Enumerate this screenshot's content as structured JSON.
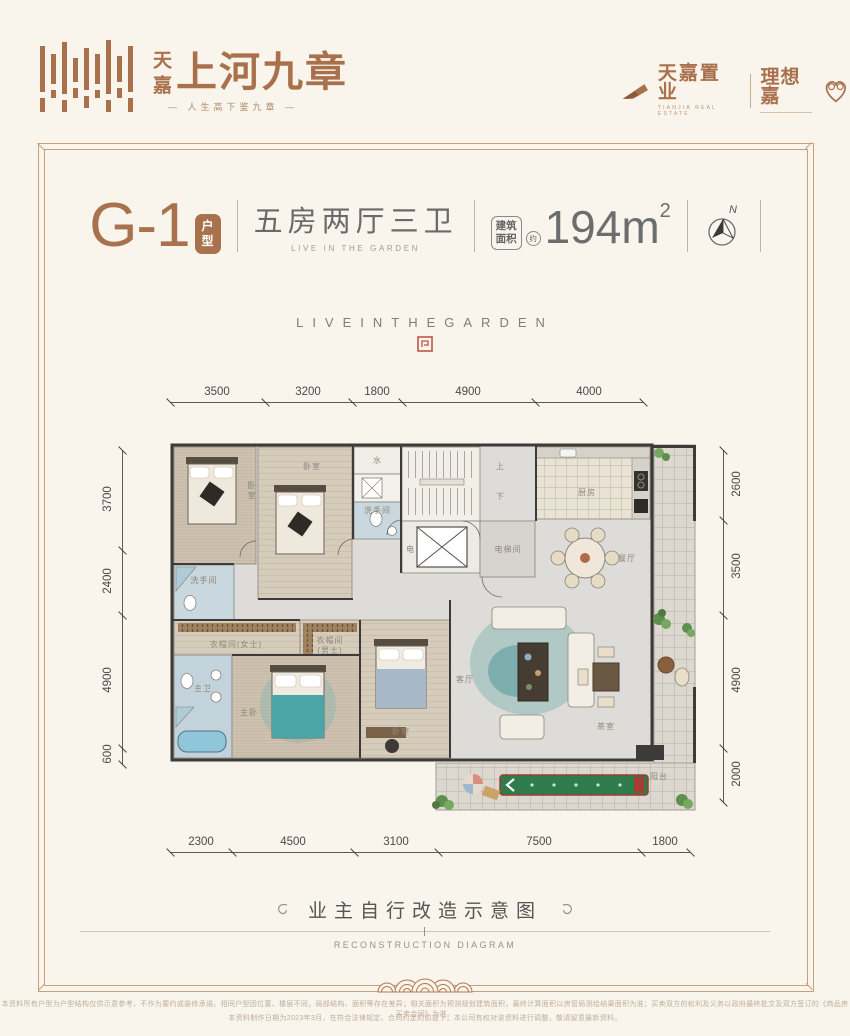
{
  "colors": {
    "background": "#f9f4ec",
    "accent": "#a9714b",
    "frame": "#c6a07b",
    "seal_red": "#c0554a",
    "wall": "#3c3b39",
    "mat_green": "#2e7b4c"
  },
  "header": {
    "brand_vertical": "天嘉",
    "brand_title": "上河九章",
    "tagline": "— 人生高下鉴九章 —",
    "developer": "天嘉置业",
    "developer_en": "TIANJIA REAL ESTATE",
    "sub_brand": "理想嘉"
  },
  "title_bar": {
    "unit_code": "G-1",
    "unit_badge_1": "户",
    "unit_badge_2": "型",
    "layout_cn": "五房两厅三卫",
    "layout_en": "LIVE IN THE GARDEN",
    "area_badge_1": "建筑",
    "area_badge_2": "面积",
    "area_approx": "约",
    "area_value": "194m",
    "area_exp": "2",
    "compass_label": "N"
  },
  "hero": {
    "spaced_text": "LIVEINTHEGARDEN"
  },
  "dimensions": {
    "top": [
      "3500",
      "3200",
      "1800",
      "4900",
      "4000"
    ],
    "bottom": [
      "2300",
      "4500",
      "3100",
      "7500",
      "1800"
    ],
    "left": [
      "3700",
      "2400",
      "4900",
      "600"
    ],
    "right": [
      "2600",
      "3500",
      "4900",
      "2000"
    ]
  },
  "rooms": {
    "bedroom_top_1": "卧室",
    "bedroom_top_2": "卧室",
    "water": "水",
    "bath_upper": "洗手间",
    "stair_up": "上",
    "stair_down": "下",
    "elec": "电",
    "elevator_hall": "电梯间",
    "kitchen": "厨房",
    "dining": "餐厅",
    "bath_lower": "洗手间",
    "cloak_female": "衣帽间(女士)",
    "cloak_male_1": "衣帽间",
    "cloak_male_2": "(男士)",
    "master_bath": "主卫",
    "master_bedroom": "主卧",
    "bedroom_mid": "卧室",
    "living": "客厅",
    "tea_room": "茶室",
    "balcony": "阳台"
  },
  "footer": {
    "title_cn": "业主自行改造示意图",
    "title_en": "RECONSTRUCTION DIAGRAM"
  },
  "disclaimer": {
    "line1": "本资料所有户型为户型结构仅供示意参考，不作为要约或装修承诺。相同户型因位置、楼层不同，局部结构、面积等存在差异；相关面积为预测规划建筑面积，最终计算面积以房管局测绘结果面积为准；买卖双方的权利及义务以政府最终批文及双方签订的《商品房买卖合同》为准。",
    "line2": "本资料制作日期为2023年3月，在符合法律规定、合同约定的前提下，本公司有权对该资料进行调整，敬请留意最新资料。"
  }
}
